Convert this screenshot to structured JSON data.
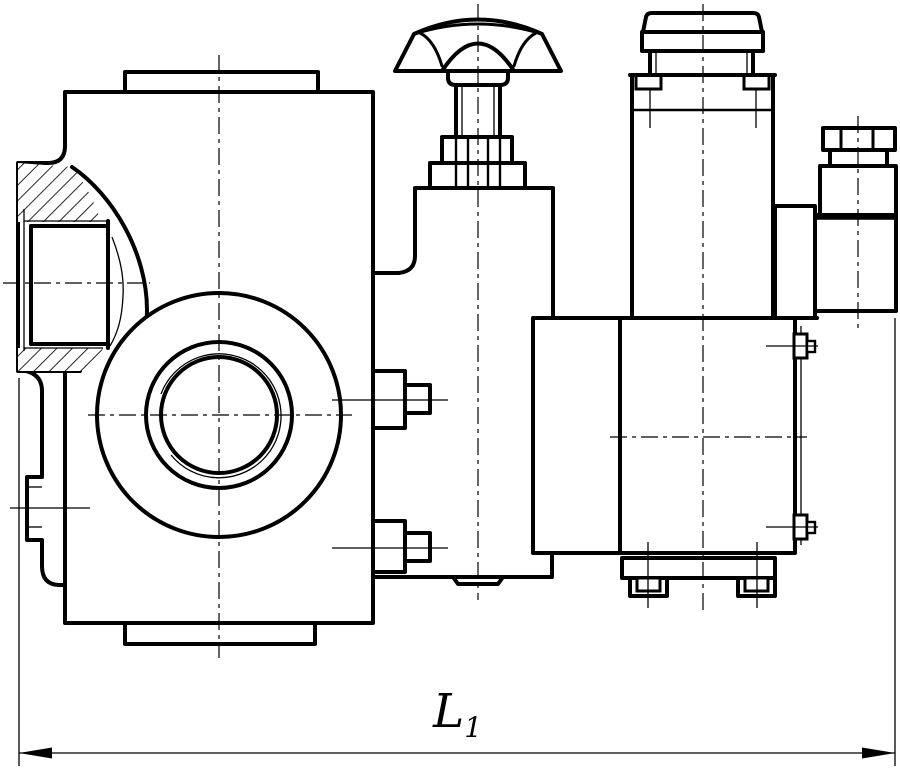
{
  "drawing": {
    "type": "technical-orthographic-view",
    "subject": "pilot-operated hydraulic valve with hand knob, solenoid and electrical connector",
    "dimension": {
      "label": "L",
      "subscript": "1"
    },
    "colors": {
      "line": "#000000",
      "background": "#ffffff"
    },
    "icons": {
      "hatch": "section-hatching-45deg",
      "centerline": "dash-dot-centerline",
      "arrows": "dimension-arrowheads"
    }
  }
}
